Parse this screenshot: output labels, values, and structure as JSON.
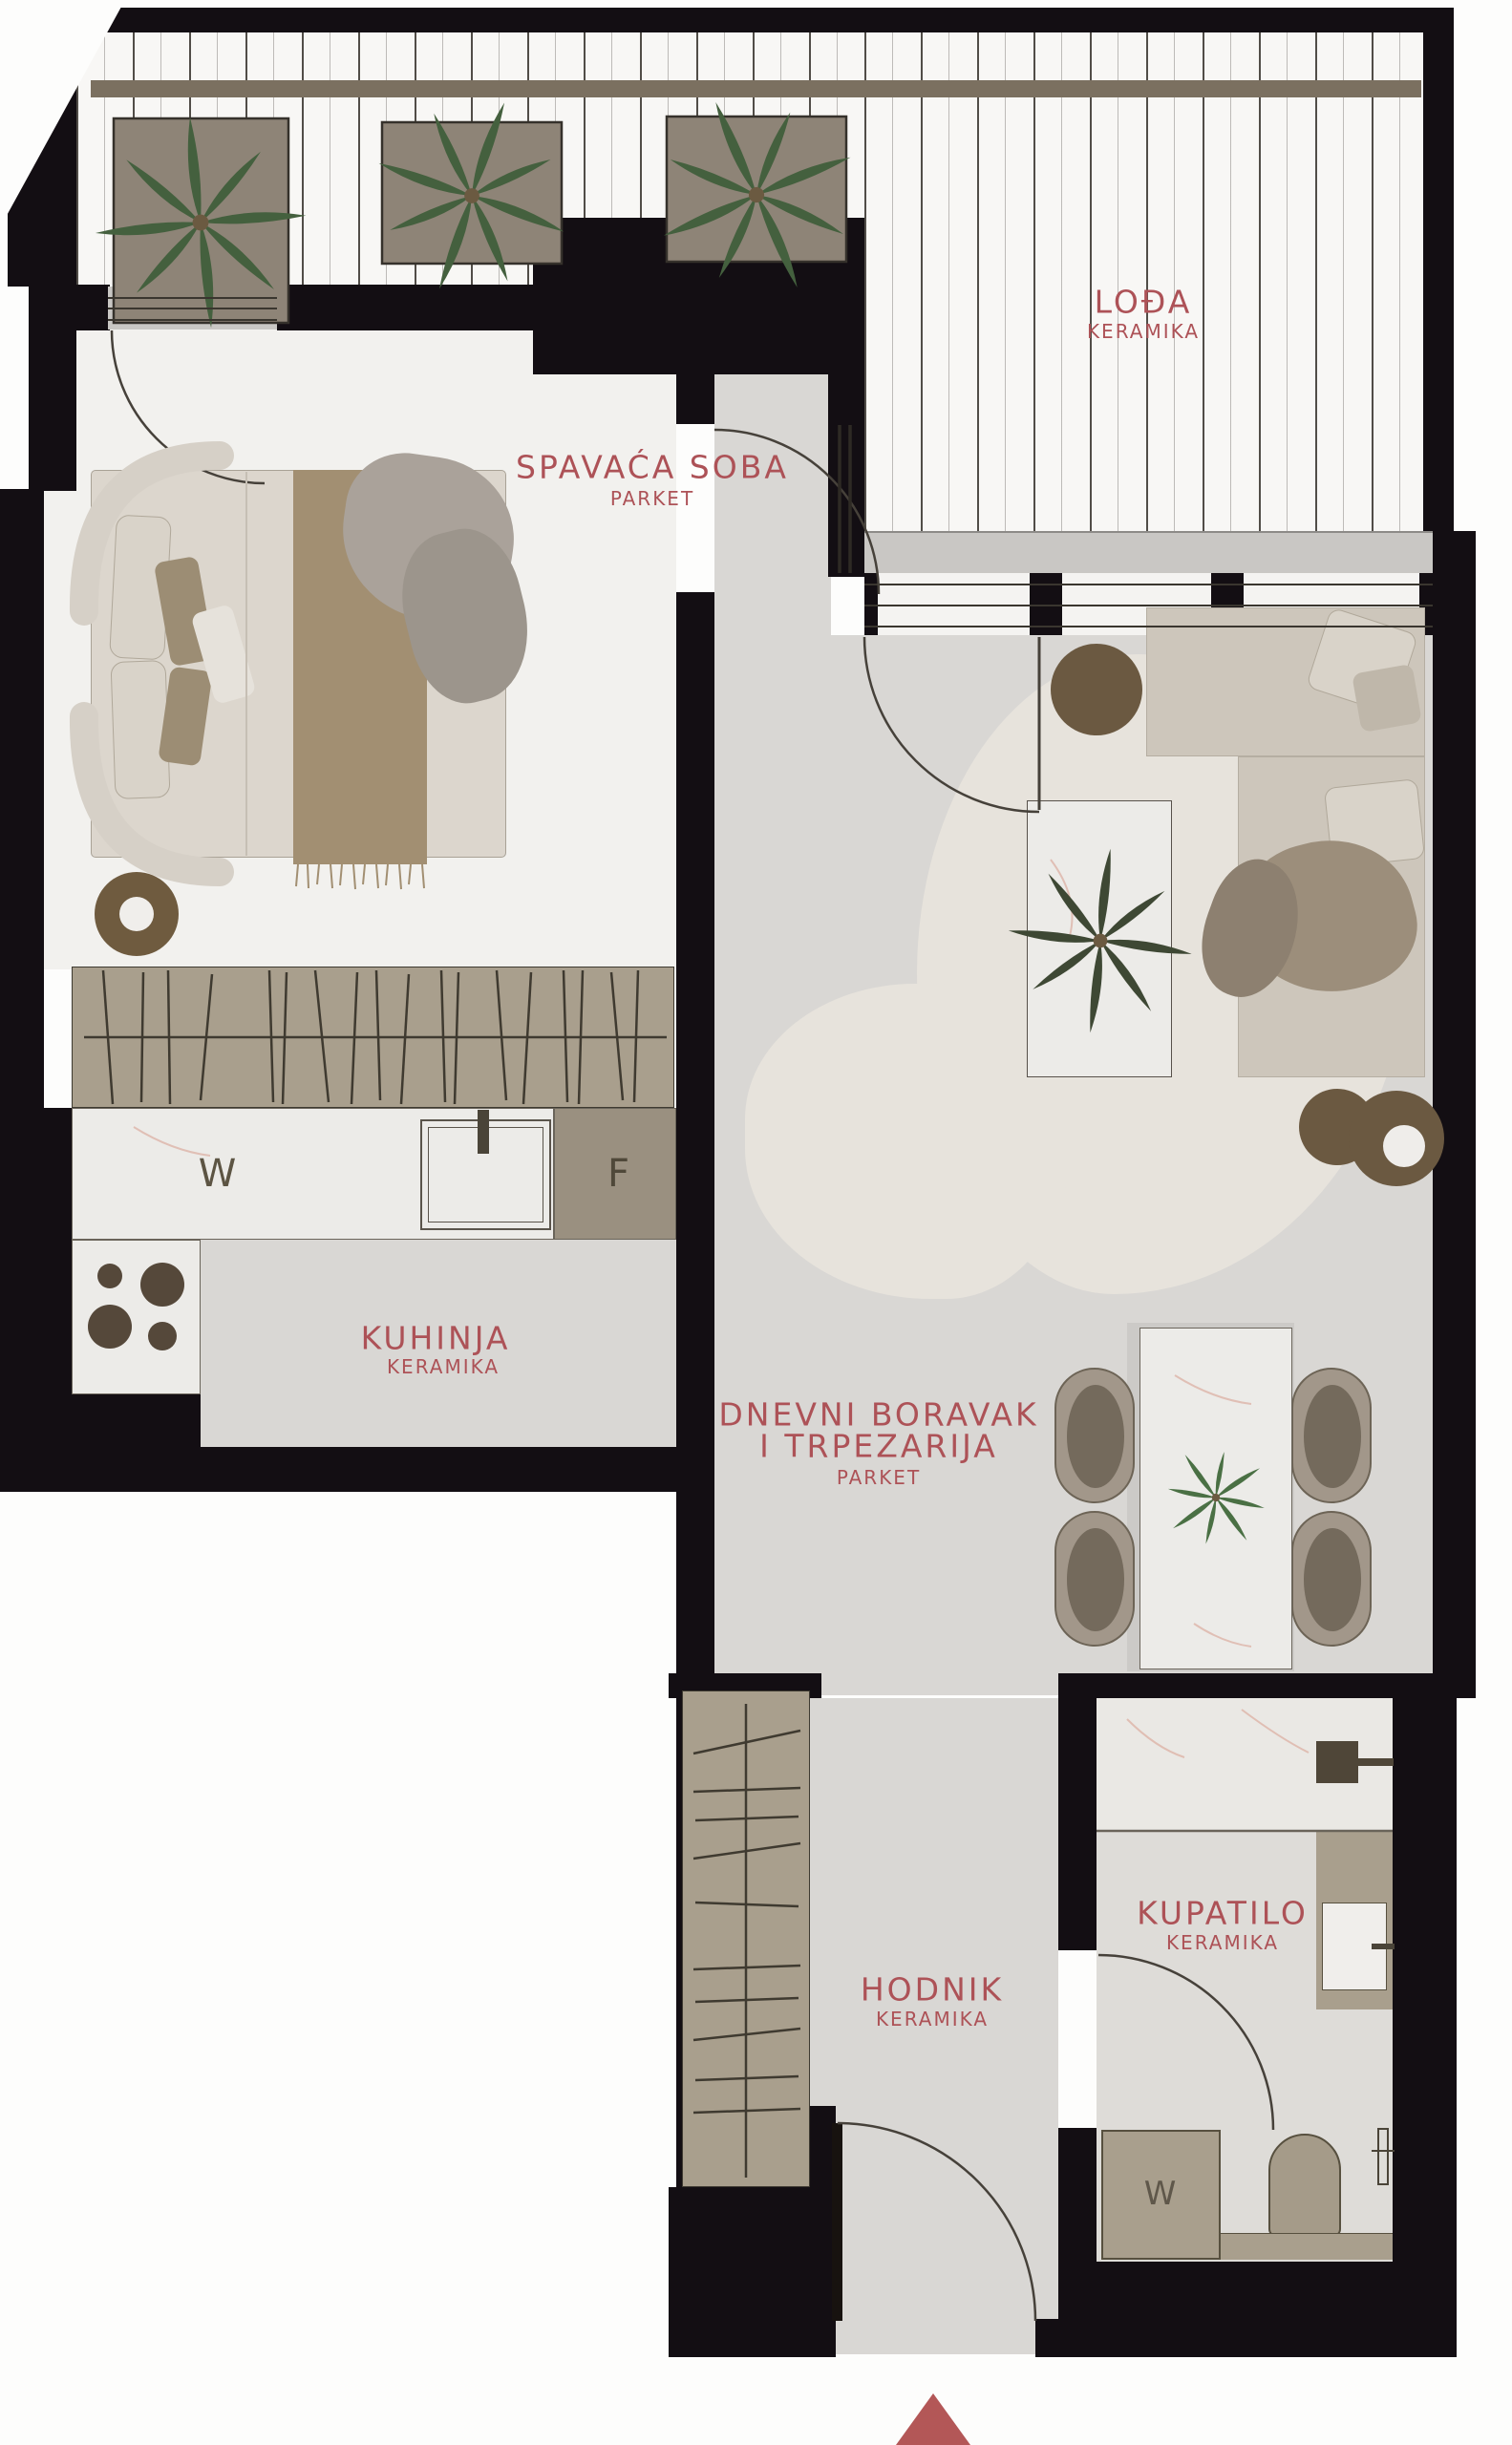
{
  "rooms": {
    "loggia": {
      "name": "LOĐA",
      "finish": "KERAMIKA"
    },
    "bedroom": {
      "name": "SPAVAĆA SOBA",
      "finish": "PARKET"
    },
    "kitchen": {
      "name": "KUHINJA",
      "finish": "KERAMIKA"
    },
    "living": {
      "line1": "DNEVNI BORAVAK",
      "line2": "I TRPEZARIJA",
      "finish": "PARKET"
    },
    "hallway": {
      "name": "HODNIK",
      "finish": "KERAMIKA"
    },
    "bathroom": {
      "name": "KUPATILO",
      "finish": "KERAMIKA"
    }
  },
  "appliances": {
    "kitchen_washer": "W",
    "kitchen_fridge": "F",
    "bathroom_washer": "W"
  },
  "colors": {
    "label_red": "#ad5257",
    "wall_black": "#130e13",
    "entrance_marker": "#b35757",
    "floor_parquet": "#f2f1ee",
    "floor_ceramic": "#d9d7d4",
    "furniture_taupe": "#a99f8d",
    "accent_brown": "#6b5941"
  },
  "markers": {
    "entrance": "entrance-arrow"
  }
}
